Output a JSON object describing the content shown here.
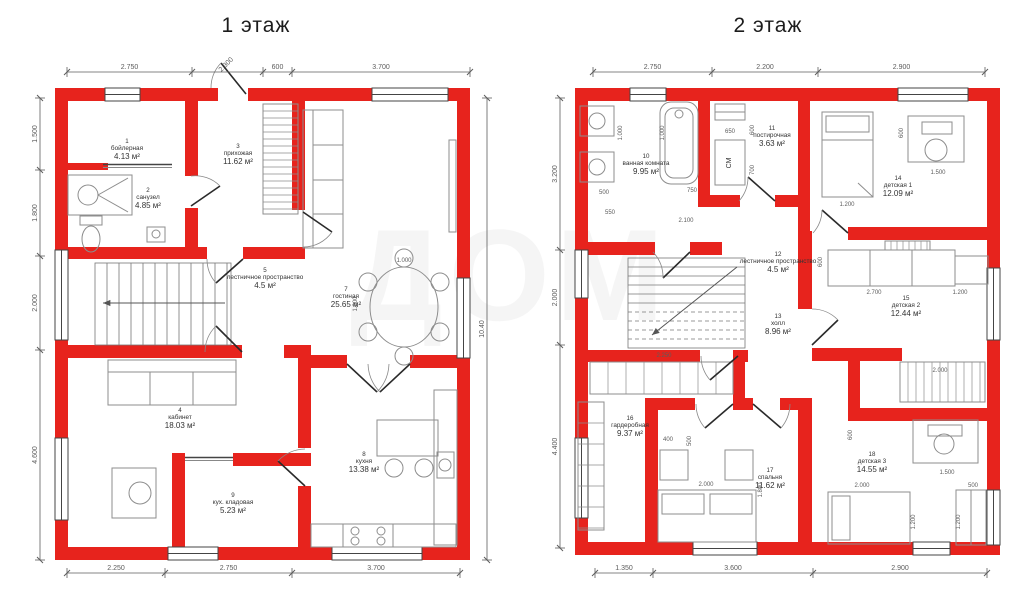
{
  "colors": {
    "wall": "#e7231d",
    "line": "#3a3a3a",
    "furniture": "#8d8d8d",
    "dimension": "#5c5c5c",
    "label": "#333333"
  },
  "watermark": "ДОМ",
  "floors": [
    {
      "title": "1 этаж",
      "rooms": [
        {
          "num": "1",
          "name": "бойлерная",
          "area": "4.13 м²",
          "x": 127,
          "y": 143
        },
        {
          "num": "2",
          "name": "санузел",
          "area": "4.85 м²",
          "x": 148,
          "y": 192
        },
        {
          "num": "3",
          "name": "прихожая",
          "area": "11.62 м²",
          "x": 238,
          "y": 148
        },
        {
          "num": "4",
          "name": "кабинет",
          "area": "18.03 м²",
          "x": 180,
          "y": 412
        },
        {
          "num": "5",
          "name": "лестничное пространство",
          "area": "4.5 м²",
          "x": 265,
          "y": 272
        },
        {
          "num": "7",
          "name": "гостиная",
          "area": "25.65 м²",
          "x": 346,
          "y": 291
        },
        {
          "num": "8",
          "name": "кухня",
          "area": "13.38 м²",
          "x": 364,
          "y": 456
        },
        {
          "num": "9",
          "name": "кух. кладовая",
          "area": "5.23 м²",
          "x": 233,
          "y": 497
        }
      ],
      "dims": {
        "top": {
          "y": 72,
          "ticks": [
            67,
            192,
            263,
            292,
            470
          ],
          "labels": [
            "2.750",
            "2.300",
            "600",
            "3.700"
          ],
          "rot": [
            1
          ]
        },
        "bottom": {
          "y": 573,
          "ticks": [
            67,
            165,
            292,
            460
          ],
          "labels": [
            "2.250",
            "2.750",
            "3.700"
          ],
          "rot": []
        },
        "left": {
          "x": 40,
          "ticks": [
            98,
            170,
            256,
            350,
            560
          ],
          "labels": [
            "1.500",
            "1.800",
            "2.000",
            "4.600"
          ],
          "rot": []
        },
        "right": {
          "x": 487,
          "ticks": [
            98,
            560
          ],
          "labels": [
            "10.40"
          ],
          "rot": []
        }
      },
      "inner_dims": [
        {
          "x": 404,
          "y": 262,
          "t": "1.000"
        },
        {
          "x": 357,
          "y": 304,
          "t": "1.800",
          "r": 1
        }
      ]
    },
    {
      "title": "2 этаж",
      "rooms": [
        {
          "num": "10",
          "name": "ванная комната",
          "area": "9.95 м²",
          "x": 646,
          "y": 158
        },
        {
          "num": "11",
          "name": "постирочная",
          "area": "3.63 м²",
          "x": 772,
          "y": 130
        },
        {
          "num": "14",
          "name": "детская 1",
          "area": "12.09 м²",
          "x": 898,
          "y": 180
        },
        {
          "num": "15",
          "name": "детская 2",
          "area": "12.44 м²",
          "x": 906,
          "y": 300
        },
        {
          "num": "12",
          "name": "лестничное пространство",
          "area": "4.5 м²",
          "x": 778,
          "y": 256
        },
        {
          "num": "13",
          "name": "холл",
          "area": "8.96 м²",
          "x": 778,
          "y": 318
        },
        {
          "num": "16",
          "name": "гардеробная",
          "area": "9.37 м²",
          "x": 630,
          "y": 420
        },
        {
          "num": "17",
          "name": "спальня",
          "area": "11.62 м²",
          "x": 770,
          "y": 472
        },
        {
          "num": "18",
          "name": "детская 3",
          "area": "14.55 м²",
          "x": 872,
          "y": 456
        }
      ],
      "dims": {
        "top": {
          "y": 72,
          "ticks": [
            593,
            712,
            818,
            985
          ],
          "labels": [
            "2.750",
            "2.200",
            "2.900"
          ],
          "rot": []
        },
        "bottom": {
          "y": 573,
          "ticks": [
            595,
            653,
            813,
            987
          ],
          "labels": [
            "1.350",
            "3.600",
            "2.900"
          ],
          "rot": []
        },
        "left": {
          "x": 560,
          "ticks": [
            98,
            250,
            345,
            548
          ],
          "labels": [
            "3.200",
            "2.000",
            "4.400"
          ],
          "rot": []
        },
        "right": null
      },
      "inner_dims": [
        {
          "x": 730,
          "y": 133,
          "t": "650"
        },
        {
          "x": 622,
          "y": 133,
          "t": "1.000",
          "r": 1
        },
        {
          "x": 664,
          "y": 133,
          "t": "1.000",
          "r": 1
        },
        {
          "x": 604,
          "y": 194,
          "t": "500"
        },
        {
          "x": 610,
          "y": 214,
          "t": "550"
        },
        {
          "x": 692,
          "y": 192,
          "t": "750"
        },
        {
          "x": 754,
          "y": 130,
          "t": "600",
          "r": 1
        },
        {
          "x": 754,
          "y": 170,
          "t": "700",
          "r": 1
        },
        {
          "x": 686,
          "y": 222,
          "t": "2.100"
        },
        {
          "x": 938,
          "y": 174,
          "t": "1.500"
        },
        {
          "x": 903,
          "y": 133,
          "t": "600",
          "r": 1
        },
        {
          "x": 847,
          "y": 206,
          "t": "1.200"
        },
        {
          "x": 874,
          "y": 294,
          "t": "2.700"
        },
        {
          "x": 960,
          "y": 294,
          "t": "1.200"
        },
        {
          "x": 822,
          "y": 262,
          "t": "600",
          "r": 1
        },
        {
          "x": 940,
          "y": 372,
          "t": "2.000"
        },
        {
          "x": 664,
          "y": 357,
          "t": "2.250"
        },
        {
          "x": 668,
          "y": 441,
          "t": "400"
        },
        {
          "x": 691,
          "y": 441,
          "t": "500",
          "r": 1
        },
        {
          "x": 706,
          "y": 486,
          "t": "2.000"
        },
        {
          "x": 762,
          "y": 490,
          "t": "1.800",
          "r": 1
        },
        {
          "x": 852,
          "y": 435,
          "t": "600",
          "r": 1
        },
        {
          "x": 947,
          "y": 474,
          "t": "1.500"
        },
        {
          "x": 862,
          "y": 487,
          "t": "2.000"
        },
        {
          "x": 973,
          "y": 487,
          "t": "500"
        },
        {
          "x": 915,
          "y": 522,
          "t": "1.200",
          "r": 1
        },
        {
          "x": 960,
          "y": 522,
          "t": "1.200",
          "r": 1
        }
      ],
      "texts": [
        {
          "x": 731,
          "y": 163,
          "t": "СМ",
          "r": 1
        }
      ]
    }
  ]
}
